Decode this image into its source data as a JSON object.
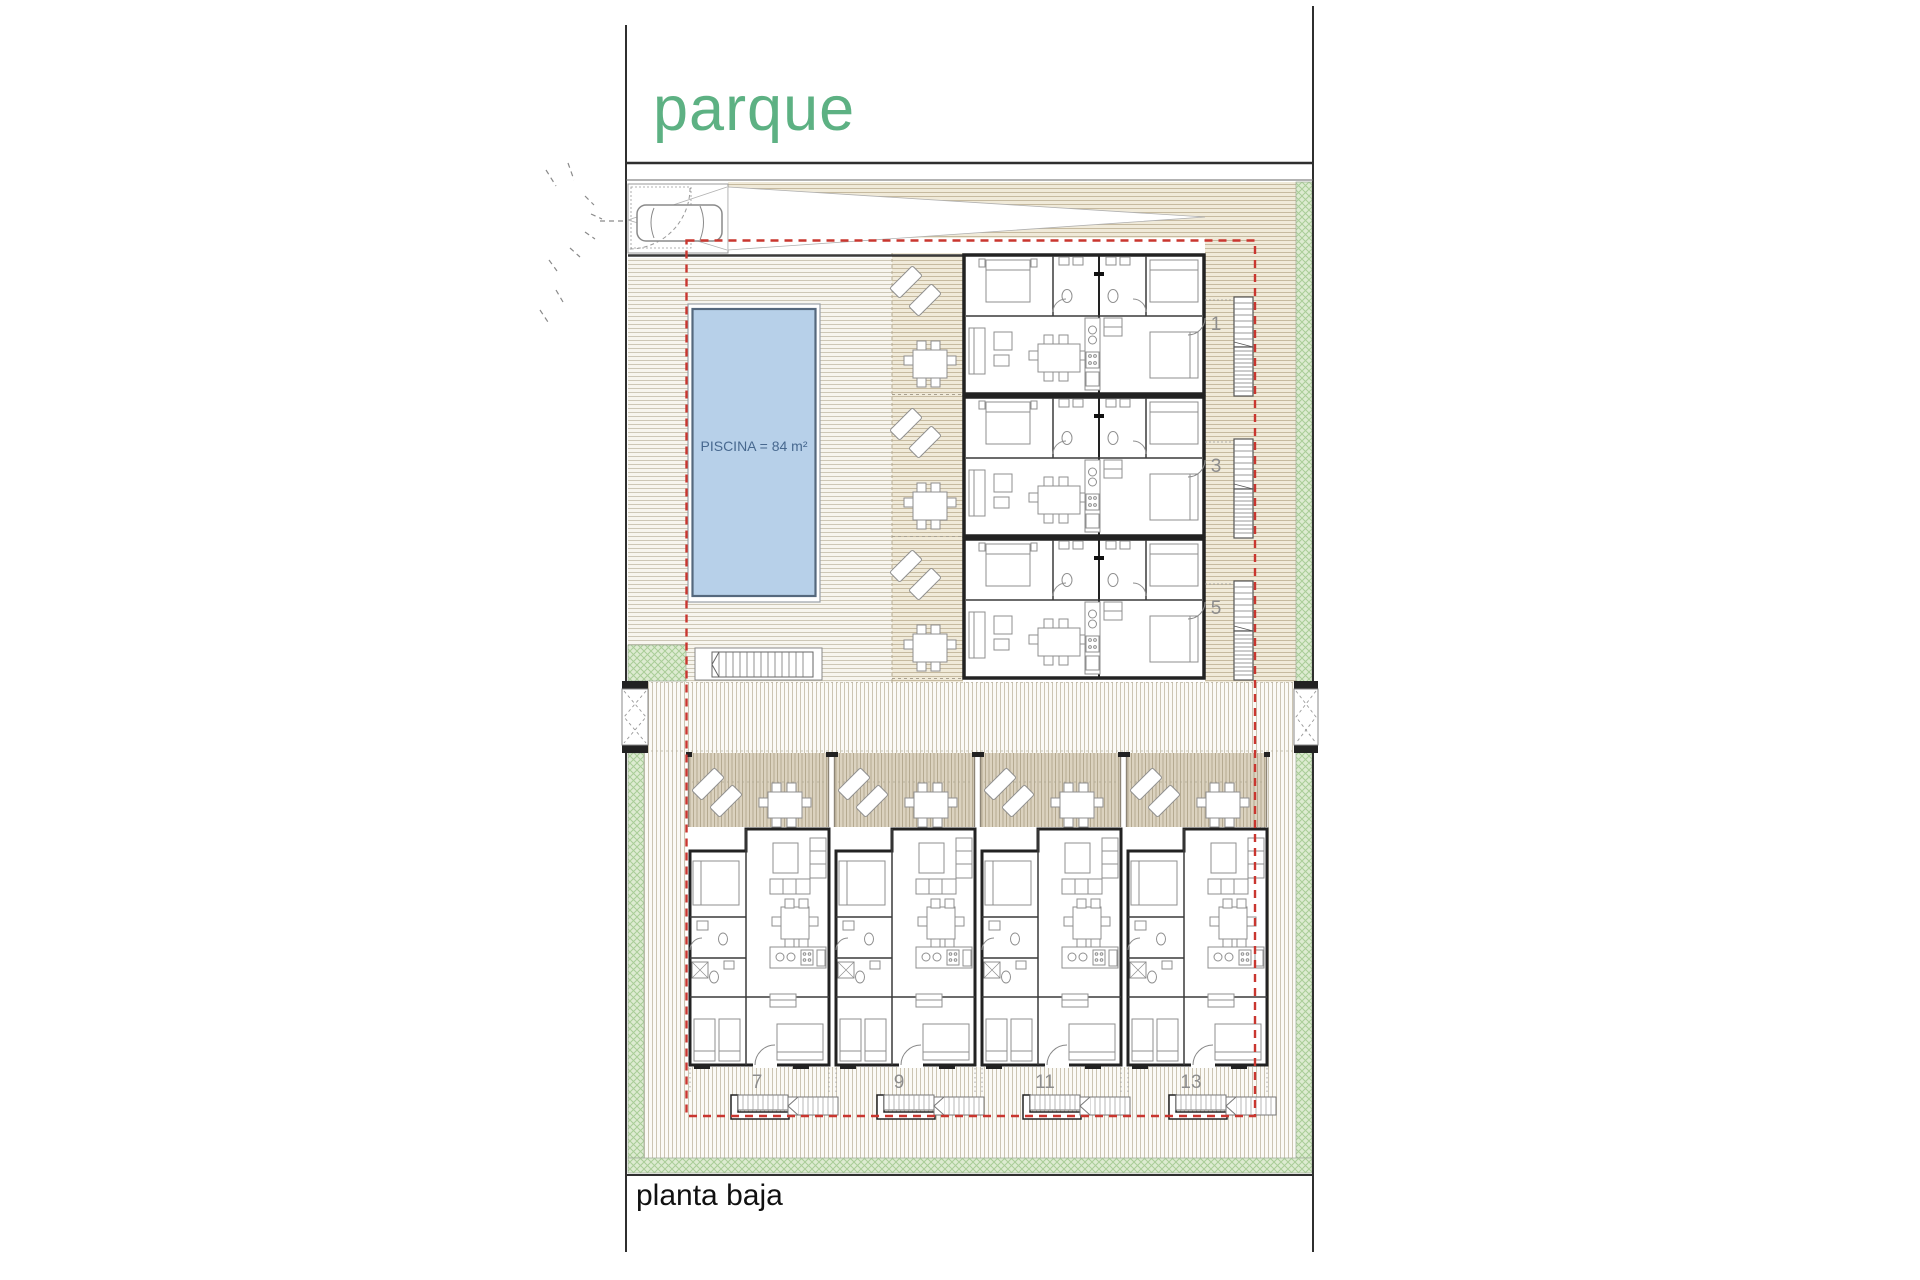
{
  "title": "planta baja",
  "labels": {
    "park": "parque",
    "pool": "PISCINA = 84 m²",
    "floor": "planta baja"
  },
  "units": {
    "right": [
      "1",
      "3",
      "5"
    ],
    "bottom": [
      "7",
      "9",
      "11",
      "13"
    ]
  },
  "colors": {
    "parque_green": "#5db183",
    "pool_water": "#b7d0e9",
    "pool_edge": "#55687d",
    "pool_text": "#47688f",
    "red_boundary": "#c9362f",
    "green_bg": "#ddebd1",
    "green_hatch": "#a9cd97",
    "deck_bg": "#f7f5ee",
    "deck_line": "#cdc7b6",
    "band_bg": "#f0ead9",
    "band_line": "#c6ba9f",
    "terrace_bg": "#dbd2bf",
    "terrace_line": "#b5aa91",
    "path_bg": "#fbfaf6",
    "path_line": "#ccc5b3",
    "wall": "#222222",
    "furniture_line": "#8f8f8f",
    "number_gray": "#8c8c8c",
    "text_black": "#111111"
  }
}
